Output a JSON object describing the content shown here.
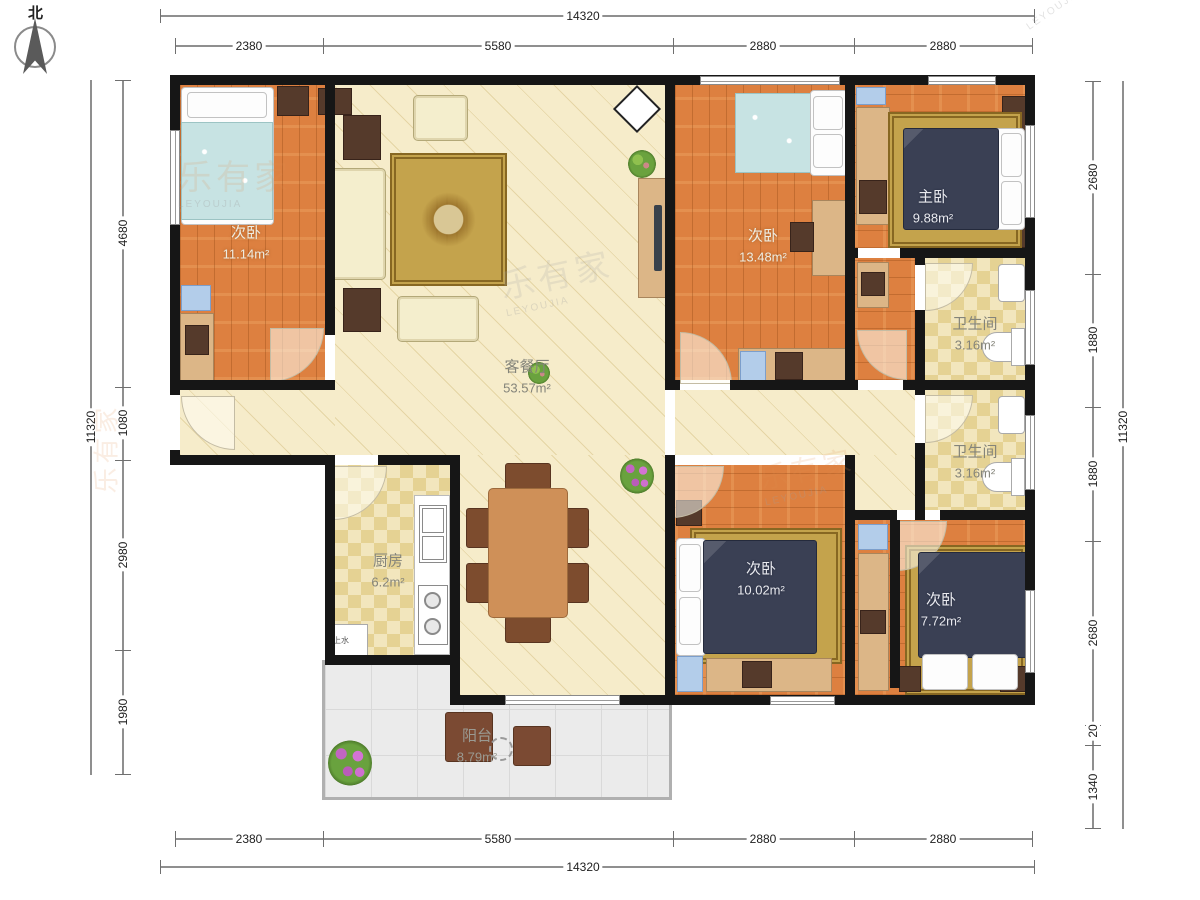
{
  "compass": {
    "label": "北"
  },
  "watermark": {
    "cn": "乐有家",
    "en": "LEYOUJIA"
  },
  "dims": {
    "top_total": "14320",
    "top_segments": [
      "2380",
      "5580",
      "2880",
      "2880"
    ],
    "bottom_segments": [
      "2380",
      "5580",
      "2880",
      "2880"
    ],
    "bottom_total": "14320",
    "left_total": "11320",
    "left_segments": [
      "4680",
      "1080",
      "2980",
      "1980"
    ],
    "right_segments": [
      "2680",
      "1880",
      "1880",
      "2680",
      "20",
      "1340"
    ],
    "right_total": "11320"
  },
  "rooms": {
    "bedroom_tl": {
      "name": "次卧",
      "area": "11.14m²"
    },
    "living": {
      "name": "客餐厅",
      "area": "53.57m²"
    },
    "bedroom_tm": {
      "name": "次卧",
      "area": "13.48m²"
    },
    "master": {
      "name": "主卧",
      "area": "9.88m²"
    },
    "bath1": {
      "name": "卫生间",
      "area": "3.16m²"
    },
    "bath2": {
      "name": "卫生间",
      "area": "3.16m²"
    },
    "kitchen": {
      "name": "厨房",
      "area": "6.2m²"
    },
    "bedroom_bl": {
      "name": "次卧",
      "area": "10.02m²"
    },
    "bedroom_br": {
      "name": "次卧",
      "area": "7.72m²"
    },
    "balcony": {
      "name": "阳台",
      "area": "8.79m²"
    },
    "utility": {
      "label": "上水"
    }
  }
}
